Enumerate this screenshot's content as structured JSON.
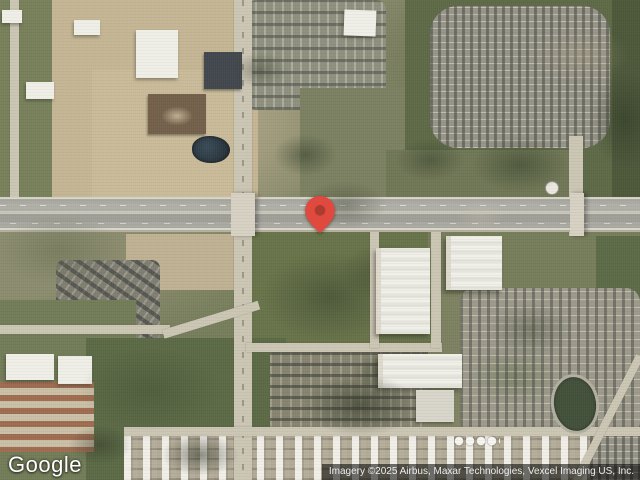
{
  "map": {
    "view_type": "satellite",
    "marker": {
      "icon": "map-pin-icon",
      "color": "#E0493E",
      "inner_dot_color": "#AE3A30",
      "position_px": {
        "x": 320,
        "y": 233
      }
    },
    "logo": {
      "text": "Google",
      "color": "#FFFFFF"
    },
    "attribution": {
      "text": "Imagery ©2025 Airbus, Maxar Technologies, Vexcel Imaging US, Inc.",
      "bar_color": "rgba(0,0,0,0.55)",
      "text_color": "#EDEDED"
    }
  }
}
